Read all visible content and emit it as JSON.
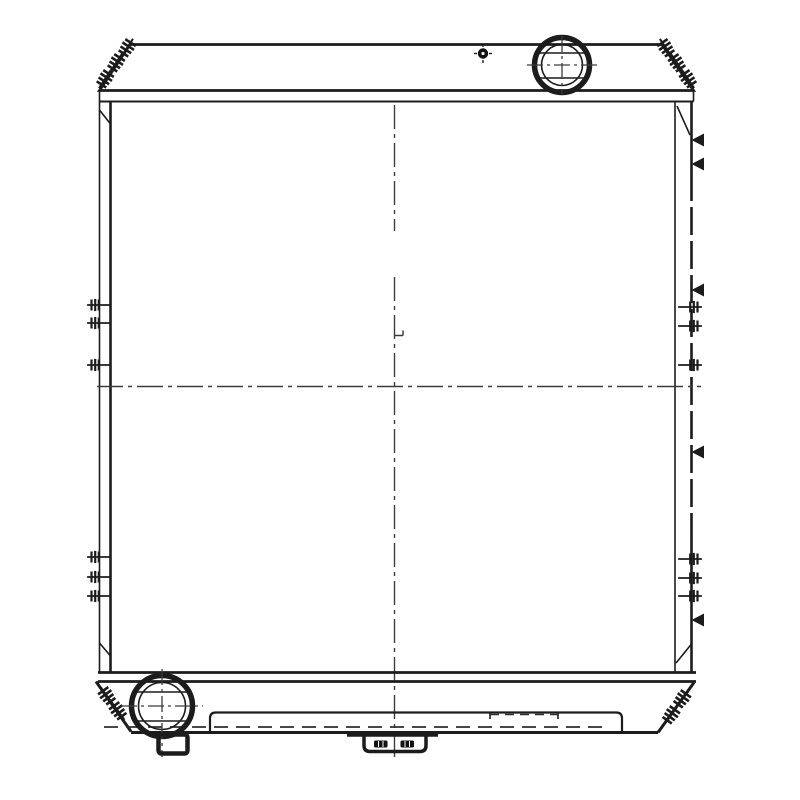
{
  "drawing": {
    "background": "#ffffff",
    "ink": "#1c1c1c",
    "centerline_ink": "#3c3c3c",
    "hidden_line_ink": "#2e2e2e",
    "highlight_fill": "#111111",
    "white": "#ffffff",
    "components": [
      "top-tank",
      "filler-neck-cap",
      "vent-port",
      "core-left-channel",
      "core-right-channel",
      "center-crosshair-lines",
      "side-mounting-bolts",
      "weld-marks",
      "corner-stud-brackets",
      "bottom-tank",
      "outlet-port",
      "drain-fitting",
      "lower-access-plate",
      "center-mounting-bracket"
    ]
  }
}
